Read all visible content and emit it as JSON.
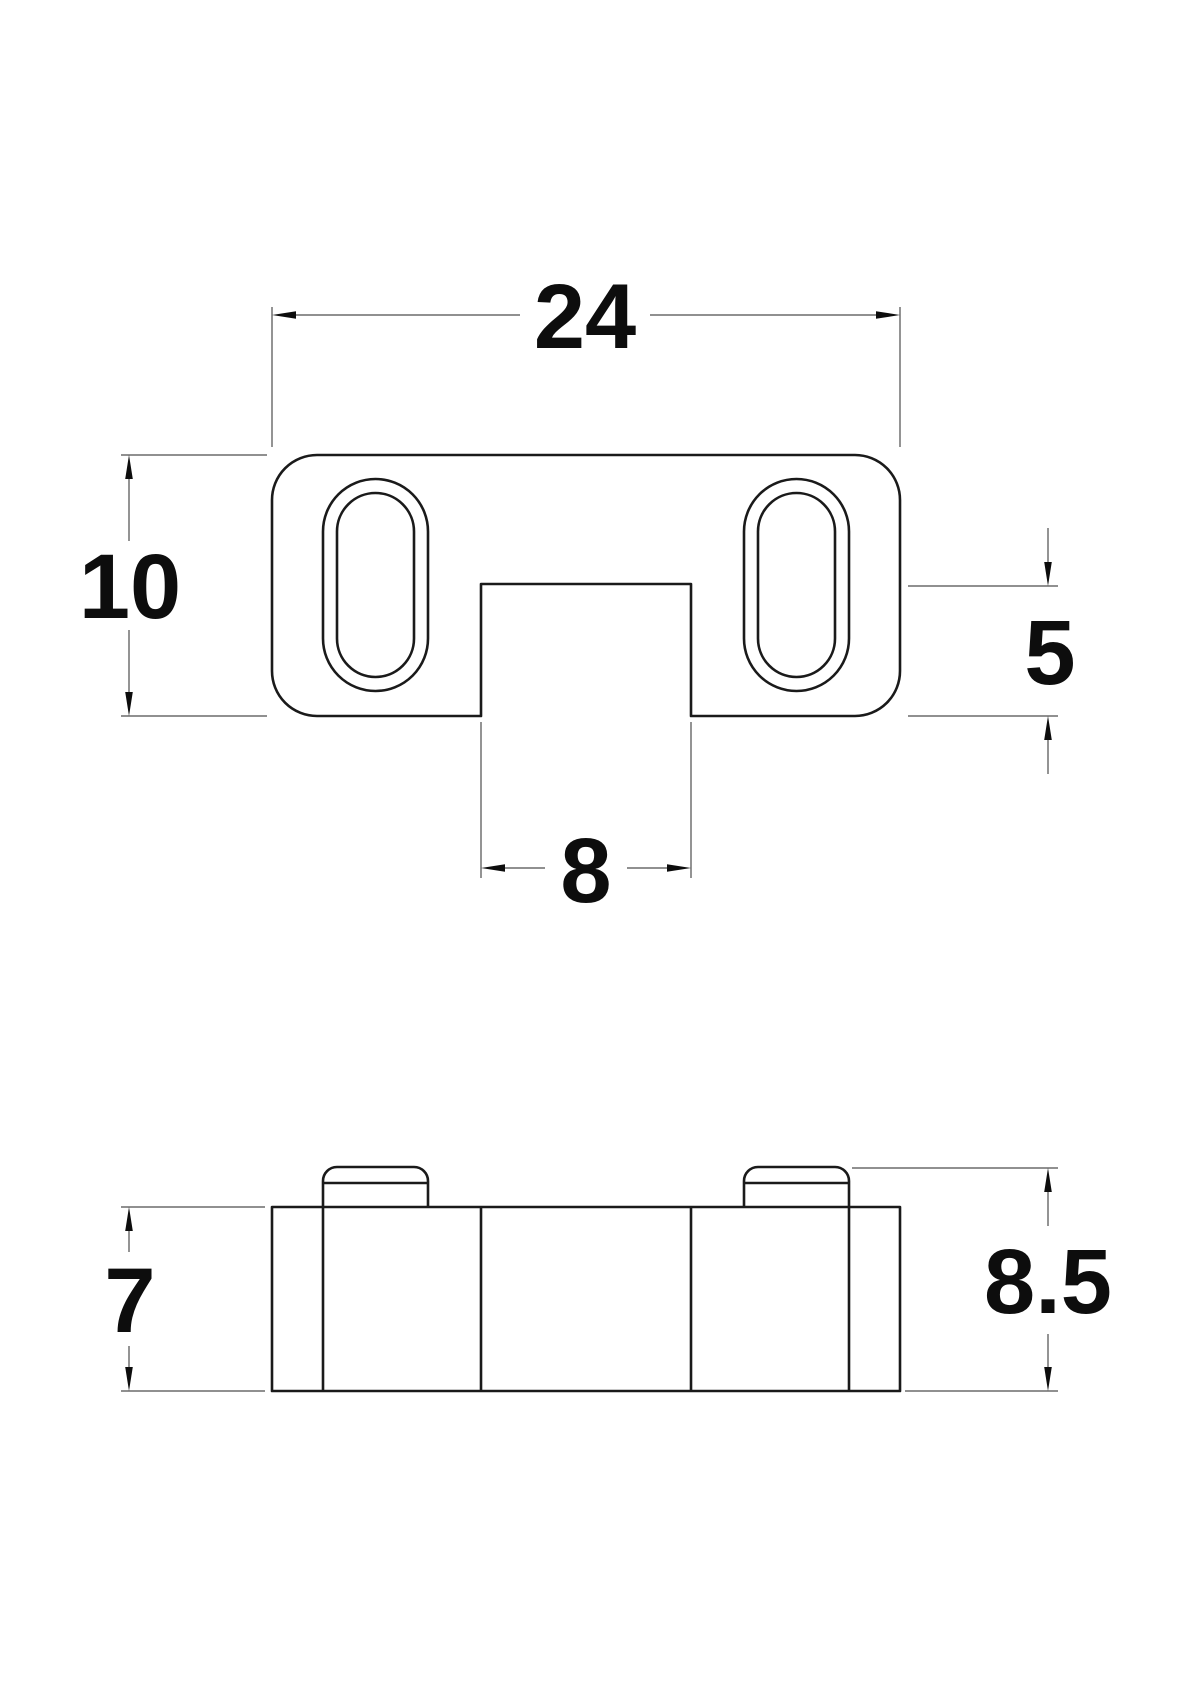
{
  "drawing": {
    "background": "#ffffff",
    "colors": {
      "part_line": "#1a1a1a",
      "dimension_line": "#4d4d4d",
      "arrow_fill": "#0d0d0d",
      "text": "#0d0d0d"
    },
    "top_view": {
      "dim_width": {
        "label": "24"
      },
      "dim_height": {
        "label": "10"
      },
      "dim_notch_depth": {
        "label": "5"
      },
      "dim_notch_width": {
        "label": "8"
      }
    },
    "side_view": {
      "dim_body_height": {
        "label": "7"
      },
      "dim_total_height": {
        "label": "8.5"
      }
    }
  }
}
